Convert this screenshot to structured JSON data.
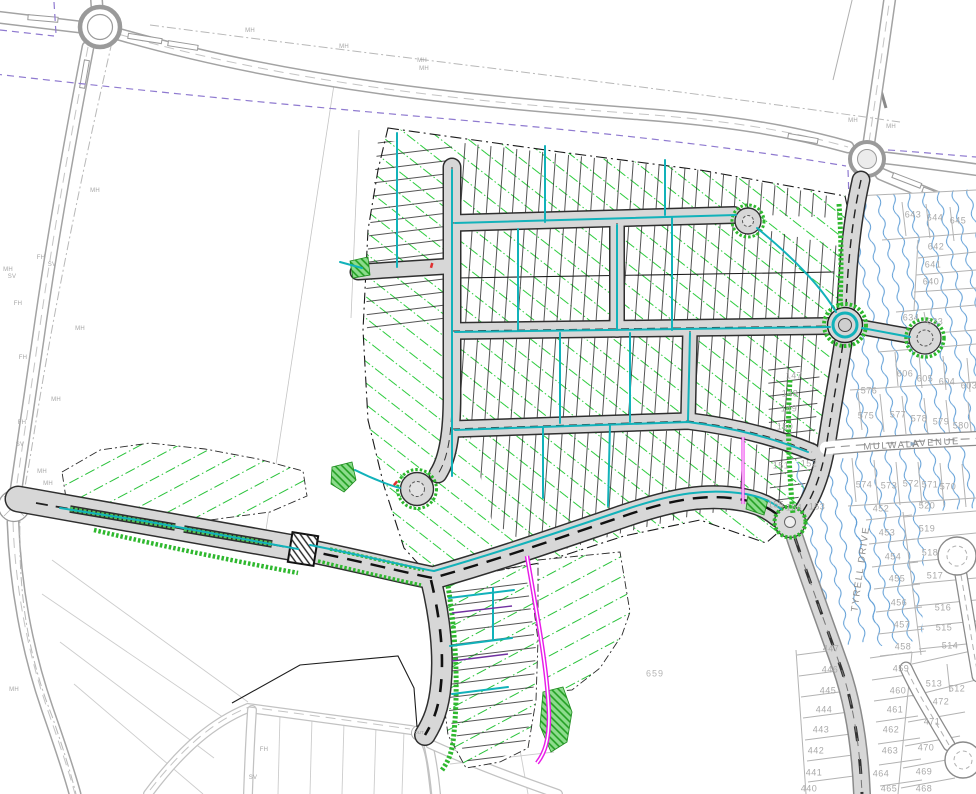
{
  "colors": {
    "road_fill": "#d7d7d7",
    "road_casing": "#2f2f2f",
    "existing_road": "#a3a3a3",
    "contour_green": "#2ecc3f",
    "contour_blue": "#5a9bd5",
    "water_cyan": "#12b2ba",
    "power_magenta": "#e81ce8",
    "utility_purple": "#8f7ad0",
    "label_gray": "#a9a9a9"
  },
  "labels": {
    "streets": [
      {
        "t": "MULWALA",
        "x": 892,
        "y": 446,
        "k": "s",
        "r": -3
      },
      {
        "t": "AVENUE",
        "x": 936,
        "y": 443,
        "k": "s",
        "r": -3
      },
      {
        "t": "TYRELL DRIVE",
        "x": 861,
        "y": 569,
        "k": "s",
        "r": -82
      }
    ],
    "flow_arrow": [
      {
        "t": "►",
        "x": 913,
        "y": 444,
        "k": "a",
        "r": -3
      }
    ],
    "lot_numbers": [
      {
        "t": "643",
        "x": 913,
        "y": 215,
        "k": "n"
      },
      {
        "t": "644",
        "x": 935,
        "y": 218,
        "k": "n"
      },
      {
        "t": "645",
        "x": 958,
        "y": 221,
        "k": "n"
      },
      {
        "t": "642",
        "x": 936,
        "y": 247,
        "k": "n"
      },
      {
        "t": "641",
        "x": 933,
        "y": 265,
        "k": "n"
      },
      {
        "t": "640",
        "x": 931,
        "y": 282,
        "k": "n"
      },
      {
        "t": "634",
        "x": 911,
        "y": 318,
        "k": "n"
      },
      {
        "t": "633",
        "x": 935,
        "y": 322,
        "k": "n"
      },
      {
        "t": "606",
        "x": 905,
        "y": 374,
        "k": "n"
      },
      {
        "t": "605",
        "x": 925,
        "y": 379,
        "k": "n"
      },
      {
        "t": "604",
        "x": 947,
        "y": 382,
        "k": "n"
      },
      {
        "t": "603",
        "x": 969,
        "y": 386,
        "k": "n"
      },
      {
        "t": "576",
        "x": 869,
        "y": 391,
        "k": "n"
      },
      {
        "t": "575",
        "x": 866,
        "y": 416,
        "k": "n"
      },
      {
        "t": "577",
        "x": 898,
        "y": 415,
        "k": "n"
      },
      {
        "t": "578",
        "x": 919,
        "y": 419,
        "k": "n"
      },
      {
        "t": "579",
        "x": 941,
        "y": 422,
        "k": "n"
      },
      {
        "t": "580",
        "x": 961,
        "y": 426,
        "k": "n"
      },
      {
        "t": "574",
        "x": 864,
        "y": 485,
        "k": "n"
      },
      {
        "t": "573",
        "x": 889,
        "y": 486,
        "k": "n"
      },
      {
        "t": "572",
        "x": 911,
        "y": 484,
        "k": "n"
      },
      {
        "t": "571",
        "x": 930,
        "y": 485,
        "k": "n"
      },
      {
        "t": "570",
        "x": 948,
        "y": 487,
        "k": "n"
      },
      {
        "t": "520",
        "x": 927,
        "y": 506,
        "k": "n"
      },
      {
        "t": "519",
        "x": 927,
        "y": 529,
        "k": "n"
      },
      {
        "t": "518",
        "x": 930,
        "y": 553,
        "k": "n"
      },
      {
        "t": "517",
        "x": 935,
        "y": 576,
        "k": "n"
      },
      {
        "t": "516",
        "x": 943,
        "y": 608,
        "k": "n"
      },
      {
        "t": "515",
        "x": 944,
        "y": 628,
        "k": "n"
      },
      {
        "t": "514",
        "x": 950,
        "y": 646,
        "k": "n"
      },
      {
        "t": "452",
        "x": 881,
        "y": 509,
        "k": "n"
      },
      {
        "t": "453",
        "x": 887,
        "y": 533,
        "k": "n"
      },
      {
        "t": "454",
        "x": 893,
        "y": 557,
        "k": "n"
      },
      {
        "t": "455",
        "x": 897,
        "y": 579,
        "k": "n"
      },
      {
        "t": "456",
        "x": 899,
        "y": 603,
        "k": "n"
      },
      {
        "t": "457",
        "x": 902,
        "y": 625,
        "k": "n"
      },
      {
        "t": "458",
        "x": 903,
        "y": 647,
        "k": "n"
      },
      {
        "t": "447",
        "x": 831,
        "y": 649,
        "k": "n"
      },
      {
        "t": "446",
        "x": 830,
        "y": 670,
        "k": "n"
      },
      {
        "t": "445",
        "x": 828,
        "y": 691,
        "k": "n"
      },
      {
        "t": "444",
        "x": 824,
        "y": 710,
        "k": "n"
      },
      {
        "t": "443",
        "x": 821,
        "y": 730,
        "k": "n"
      },
      {
        "t": "442",
        "x": 816,
        "y": 751,
        "k": "n"
      },
      {
        "t": "441",
        "x": 814,
        "y": 773,
        "k": "n"
      },
      {
        "t": "440",
        "x": 809,
        "y": 789,
        "k": "n"
      },
      {
        "t": "459",
        "x": 901,
        "y": 669,
        "k": "n"
      },
      {
        "t": "460",
        "x": 898,
        "y": 691,
        "k": "n"
      },
      {
        "t": "461",
        "x": 895,
        "y": 710,
        "k": "n"
      },
      {
        "t": "462",
        "x": 891,
        "y": 730,
        "k": "n"
      },
      {
        "t": "463",
        "x": 890,
        "y": 751,
        "k": "n"
      },
      {
        "t": "464",
        "x": 881,
        "y": 774,
        "k": "n"
      },
      {
        "t": "465",
        "x": 889,
        "y": 789,
        "k": "n"
      },
      {
        "t": "513",
        "x": 934,
        "y": 684,
        "k": "n"
      },
      {
        "t": "512",
        "x": 957,
        "y": 689,
        "k": "n"
      },
      {
        "t": "472",
        "x": 941,
        "y": 702,
        "k": "n"
      },
      {
        "t": "471",
        "x": 932,
        "y": 722,
        "k": "n"
      },
      {
        "t": "470",
        "x": 926,
        "y": 748,
        "k": "n"
      },
      {
        "t": "469",
        "x": 924,
        "y": 772,
        "k": "n"
      },
      {
        "t": "468",
        "x": 924,
        "y": 789,
        "k": "n"
      },
      {
        "t": "147",
        "x": 794,
        "y": 376,
        "k": "n"
      },
      {
        "t": "148",
        "x": 790,
        "y": 394,
        "k": "n"
      },
      {
        "t": "149",
        "x": 789,
        "y": 409,
        "k": "n"
      },
      {
        "t": "150",
        "x": 785,
        "y": 427,
        "k": "n"
      },
      {
        "t": "151",
        "x": 781,
        "y": 466,
        "k": "n"
      },
      {
        "t": "152",
        "x": 809,
        "y": 464,
        "k": "n"
      },
      {
        "t": "153",
        "x": 817,
        "y": 507,
        "k": "n"
      },
      {
        "t": "154",
        "x": 794,
        "y": 508,
        "k": "n"
      },
      {
        "t": "155",
        "x": 776,
        "y": 505,
        "k": "n"
      }
    ],
    "utilities": [
      {
        "t": "MH",
        "x": 95,
        "y": 191,
        "k": "u"
      },
      {
        "t": "MH",
        "x": 80,
        "y": 329,
        "k": "u"
      },
      {
        "t": "MH",
        "x": 56,
        "y": 400,
        "k": "u"
      },
      {
        "t": "MH",
        "x": 8,
        "y": 270,
        "k": "u"
      },
      {
        "t": "MH",
        "x": 14,
        "y": 690,
        "k": "u"
      },
      {
        "t": "MH",
        "x": 42,
        "y": 472,
        "k": "u"
      },
      {
        "t": "MH",
        "x": 48,
        "y": 484,
        "k": "u"
      },
      {
        "t": "MH",
        "x": 250,
        "y": 31,
        "k": "u"
      },
      {
        "t": "MH",
        "x": 344,
        "y": 47,
        "k": "u"
      },
      {
        "t": "MH",
        "x": 422,
        "y": 61,
        "k": "u"
      },
      {
        "t": "MH",
        "x": 424,
        "y": 69,
        "k": "u"
      },
      {
        "t": "MH",
        "x": 853,
        "y": 121,
        "k": "u"
      },
      {
        "t": "MH",
        "x": 891,
        "y": 127,
        "k": "u"
      },
      {
        "t": "SV",
        "x": 12,
        "y": 277,
        "k": "u"
      },
      {
        "t": "SV",
        "x": 52,
        "y": 265,
        "k": "u"
      },
      {
        "t": "SV",
        "x": 20,
        "y": 445,
        "k": "u"
      },
      {
        "t": "SV",
        "x": 253,
        "y": 778,
        "k": "u"
      },
      {
        "t": "FH",
        "x": 41,
        "y": 258,
        "k": "u"
      },
      {
        "t": "FH",
        "x": 18,
        "y": 304,
        "k": "u"
      },
      {
        "t": "FH",
        "x": 23,
        "y": 358,
        "k": "u"
      },
      {
        "t": "FH",
        "x": 22,
        "y": 423,
        "k": "u"
      },
      {
        "t": "FH",
        "x": 264,
        "y": 750,
        "k": "u"
      },
      {
        "t": "OUT",
        "x": 419,
        "y": 733,
        "k": "o"
      }
    ],
    "specials": [
      {
        "t": "659",
        "x": 655,
        "y": 674,
        "k": "sp"
      }
    ]
  }
}
